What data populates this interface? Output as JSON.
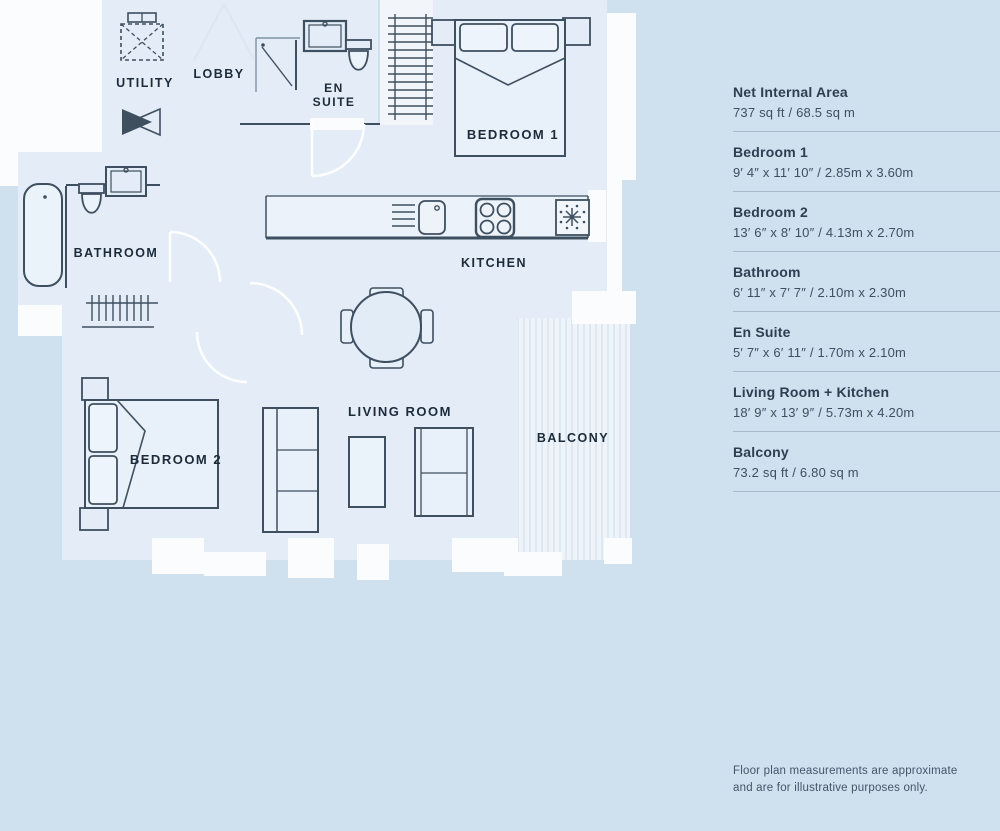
{
  "plan": {
    "rooms": {
      "utility": "UTILITY",
      "lobby": "LOBBY",
      "en_suite_line1": "EN",
      "en_suite_line2": "SUITE",
      "bedroom1": "BEDROOM 1",
      "kitchen": "KITCHEN",
      "bathroom": "BATHROOM",
      "bedroom2": "BEDROOM 2",
      "living_room": "LIVING ROOM",
      "balcony": "BALCONY"
    }
  },
  "legend": {
    "entries": [
      {
        "name": "Net Internal Area",
        "dimensions": "737 sq ft / 68.5 sq m"
      },
      {
        "name": "Bedroom 1",
        "dimensions": "9′ 4″ x 11′ 10″ / 2.85m x 3.60m"
      },
      {
        "name": "Bedroom 2",
        "dimensions": "13′ 6″ x 8′ 10″ / 4.13m x 2.70m"
      },
      {
        "name": "Bathroom",
        "dimensions": "6′ 11″ x 7′ 7″ / 2.10m x 2.30m"
      },
      {
        "name": "En Suite",
        "dimensions": "5′ 7″ x 6′ 11″ / 1.70m x 2.10m"
      },
      {
        "name": "Living Room + Kitchen",
        "dimensions": "18′ 9″ x 13′ 9″ / 5.73m x 4.20m"
      },
      {
        "name": "Balcony",
        "dimensions": "73.2 sq ft / 6.80 sq m"
      }
    ]
  },
  "disclaimer": {
    "line1": "Floor plan measurements are approximate",
    "line2": "and are for illustrative purposes only."
  },
  "colors": {
    "page_background": "#cfe0ef",
    "floor": "#e4edf7",
    "outside_white": "#fbfcfe",
    "wall_line": "#3e4f60",
    "plan_label_text": "#1c2b3a",
    "balcony_stripe": "#dde8f3",
    "legend_title": "#2c4052",
    "legend_value": "#3c5062",
    "divider": "#a7bac9"
  }
}
